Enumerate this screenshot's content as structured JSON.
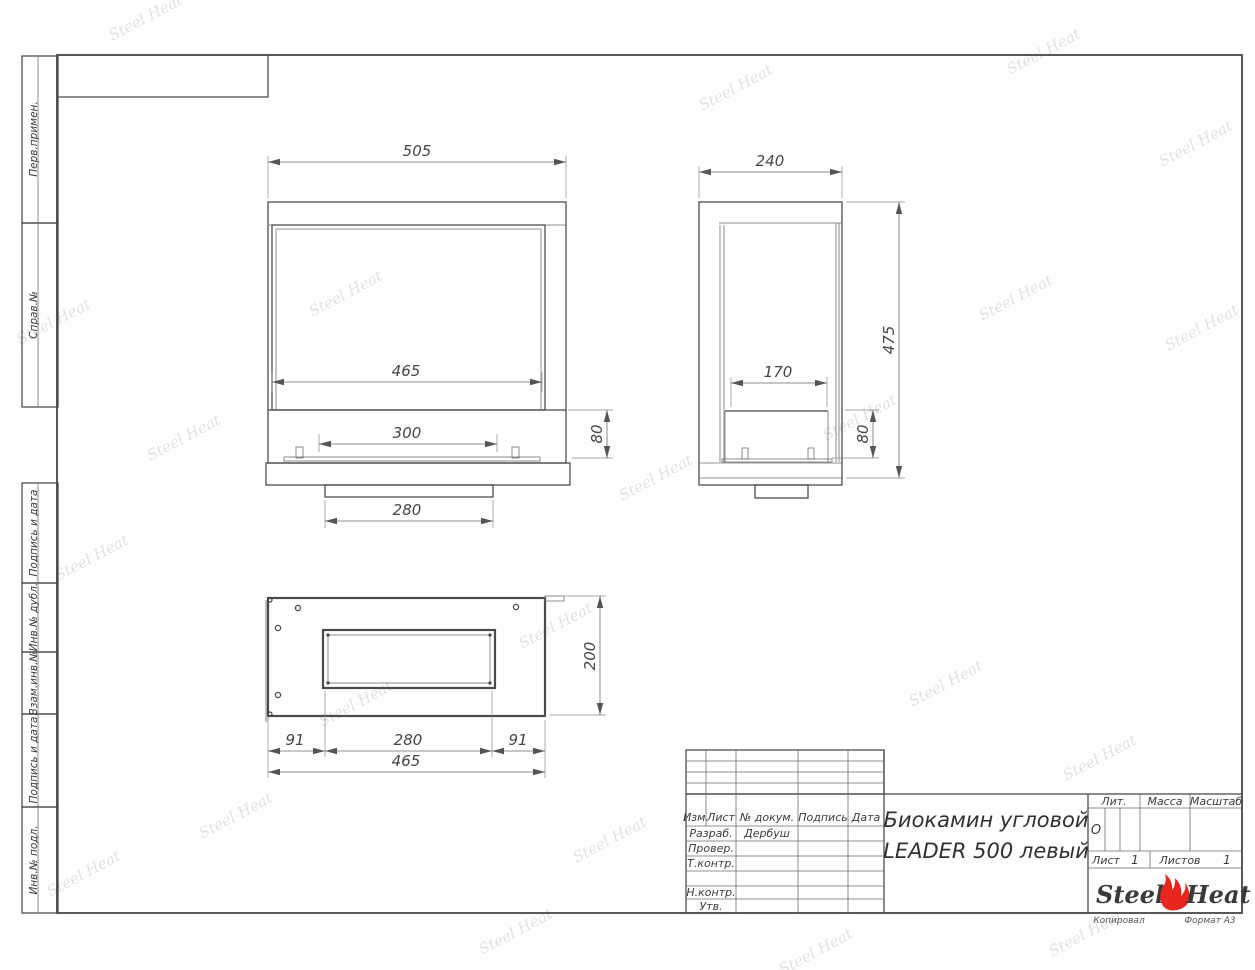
{
  "sheet": {
    "watermark_text": "Steel Heat",
    "copied_label": "Копировал",
    "format_label": "Формат А3"
  },
  "sidebar": {
    "boxes": [
      {
        "label": "Перв.примен."
      },
      {
        "label": "Справ.№"
      },
      {
        "label": "Подпись и дата"
      },
      {
        "label": "Инв.№ дубл."
      },
      {
        "label": "Взам.инв.№"
      },
      {
        "label": "Подпись и дата"
      },
      {
        "label": "Инв.№ подл."
      }
    ]
  },
  "drawing": {
    "front_view": {
      "width": "505",
      "glass_width": "465",
      "burner_width": "300",
      "base_width": "280",
      "shelf_height": "80"
    },
    "side_view": {
      "depth": "240",
      "height": "475",
      "inner_depth": "170",
      "shelf_height": "80"
    },
    "bottom_view": {
      "left_offset": "91",
      "opening_width": "280",
      "right_offset": "91",
      "total_width": "465",
      "depth": "200"
    }
  },
  "title_block": {
    "columns": {
      "izm": "Изм.",
      "list": "Лист",
      "doc": "№ докум.",
      "sign": "Подпись",
      "date": "Дата"
    },
    "rows": [
      {
        "label": "Разраб.",
        "value": "Дербуш"
      },
      {
        "label": "Провер.",
        "value": ""
      },
      {
        "label": "Т.контр.",
        "value": ""
      },
      {
        "label": "Н.контр.",
        "value": ""
      },
      {
        "label": "Утв.",
        "value": ""
      }
    ],
    "title_line1": "Биокамин угловой",
    "title_line2": "LEADER 500 левый",
    "lit_label": "Лит.",
    "lit_value": "О",
    "mass_label": "Масса",
    "scale_label": "Масштаб",
    "sheet_label": "Лист",
    "sheet_number": "1",
    "sheets_label": "Листов",
    "sheets_total": "1",
    "logo": {
      "part1": "Steel",
      "part2": "Heat"
    }
  }
}
